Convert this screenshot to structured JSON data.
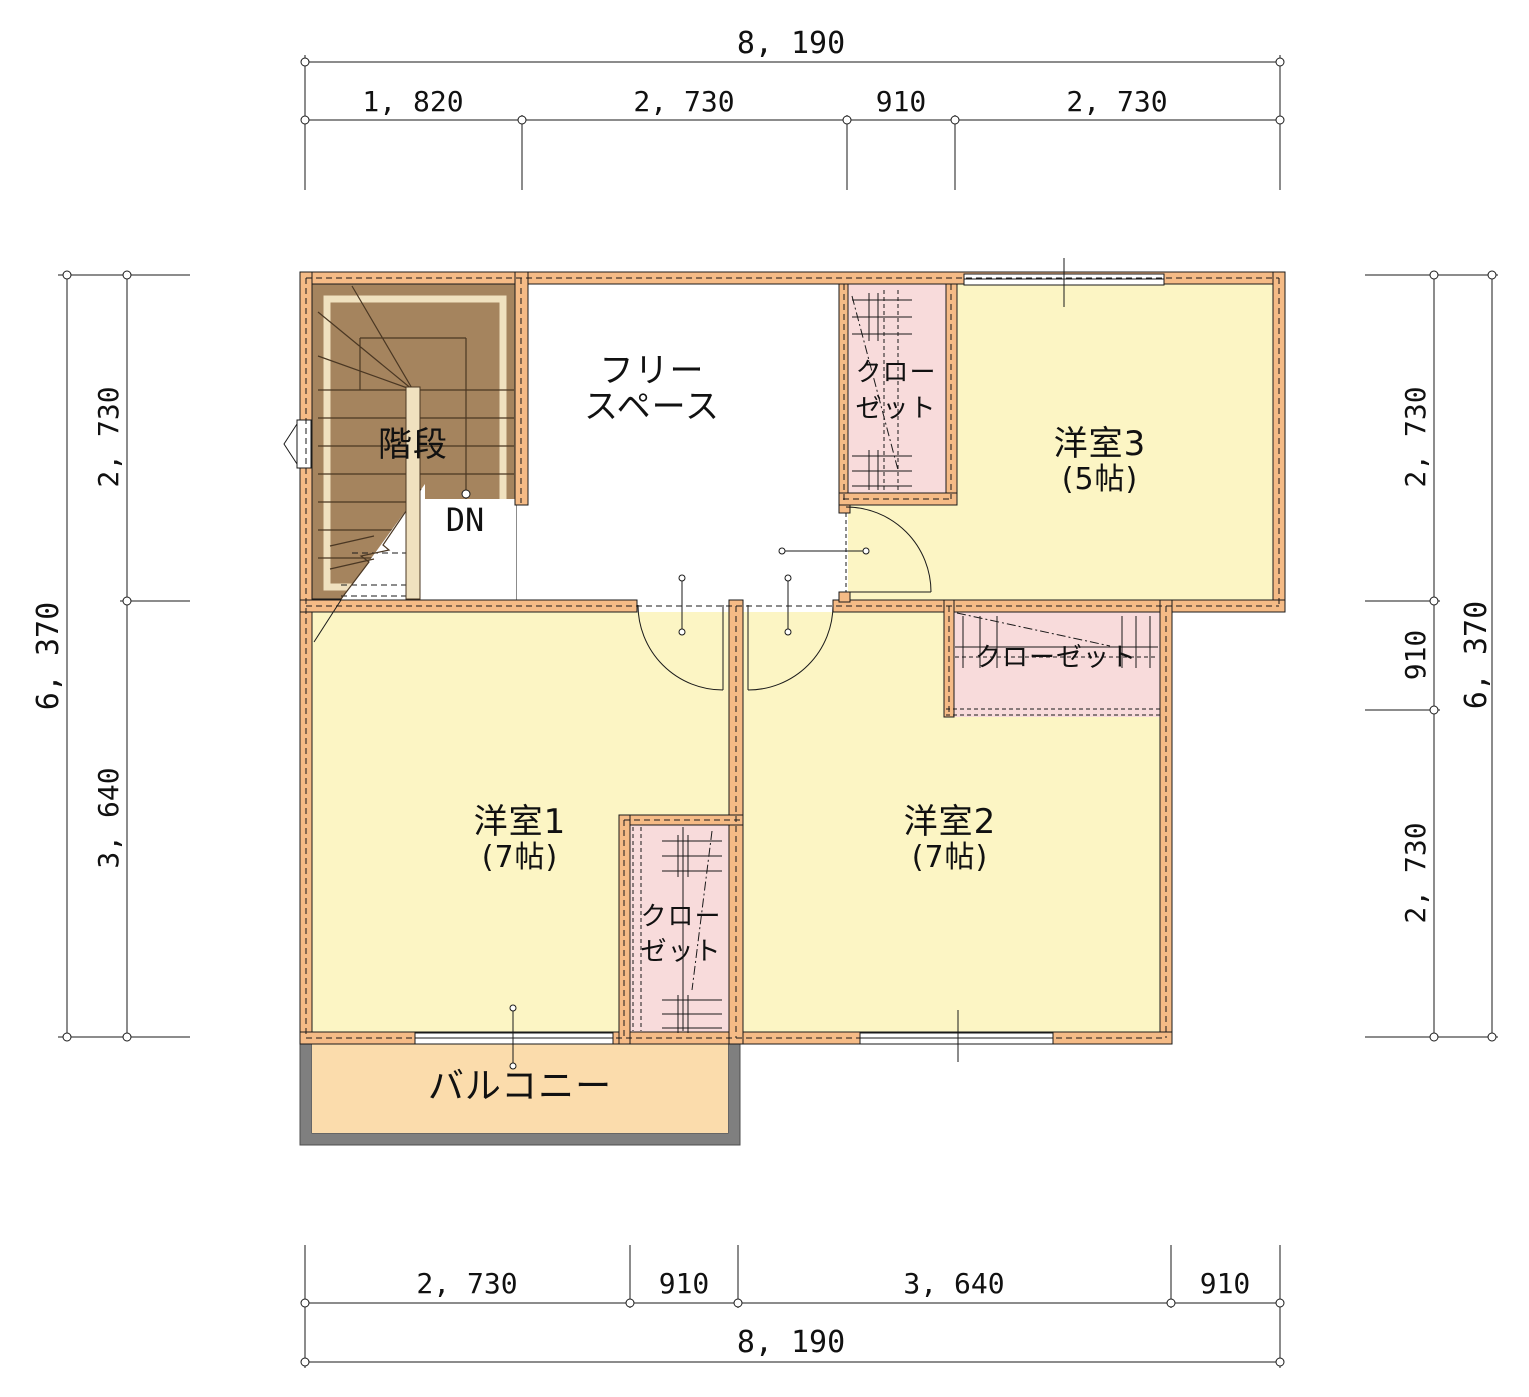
{
  "plan": {
    "rooms": {
      "free_space": {
        "line1": "フリー",
        "line2": "スペース"
      },
      "stairs": {
        "label": "階段",
        "down": "DN"
      },
      "room3": {
        "name": "洋室3",
        "size": "(5帖)"
      },
      "room1": {
        "name": "洋室1",
        "size": "(7帖)"
      },
      "room2": {
        "name": "洋室2",
        "size": "(7帖)"
      },
      "balcony": {
        "label": "バルコニー"
      },
      "closet_top": {
        "line1": "クロー",
        "line2": "ゼット"
      },
      "closet_mid": {
        "label": "クローゼット"
      },
      "closet_r1": {
        "line1": "クロー",
        "line2": "ゼット"
      }
    },
    "dimensions": {
      "top": {
        "total": "8, 190",
        "seg1": "1, 820",
        "seg2": "2, 730",
        "seg3": "910",
        "seg4": "2, 730"
      },
      "bottom": {
        "total": "8, 190",
        "seg1": "2, 730",
        "seg2": "910",
        "seg3": "3, 640",
        "seg4": "910"
      },
      "left": {
        "total": "6, 370",
        "seg1": "2, 730",
        "seg2": "3, 640"
      },
      "right": {
        "total": "6, 370",
        "seg1": "2, 730",
        "seg2": "910",
        "seg3": "2, 730"
      }
    },
    "colors": {
      "wall": "#F5BB86",
      "room": "#FCF5C4",
      "closet": "#F8DBDB",
      "stairs": "#A5845E",
      "stair_trim": "#F0E1BF",
      "balcony_fill": "#FBDCAC",
      "balcony_frame": "#7F7F7F",
      "line": "#1A1A1A"
    }
  }
}
